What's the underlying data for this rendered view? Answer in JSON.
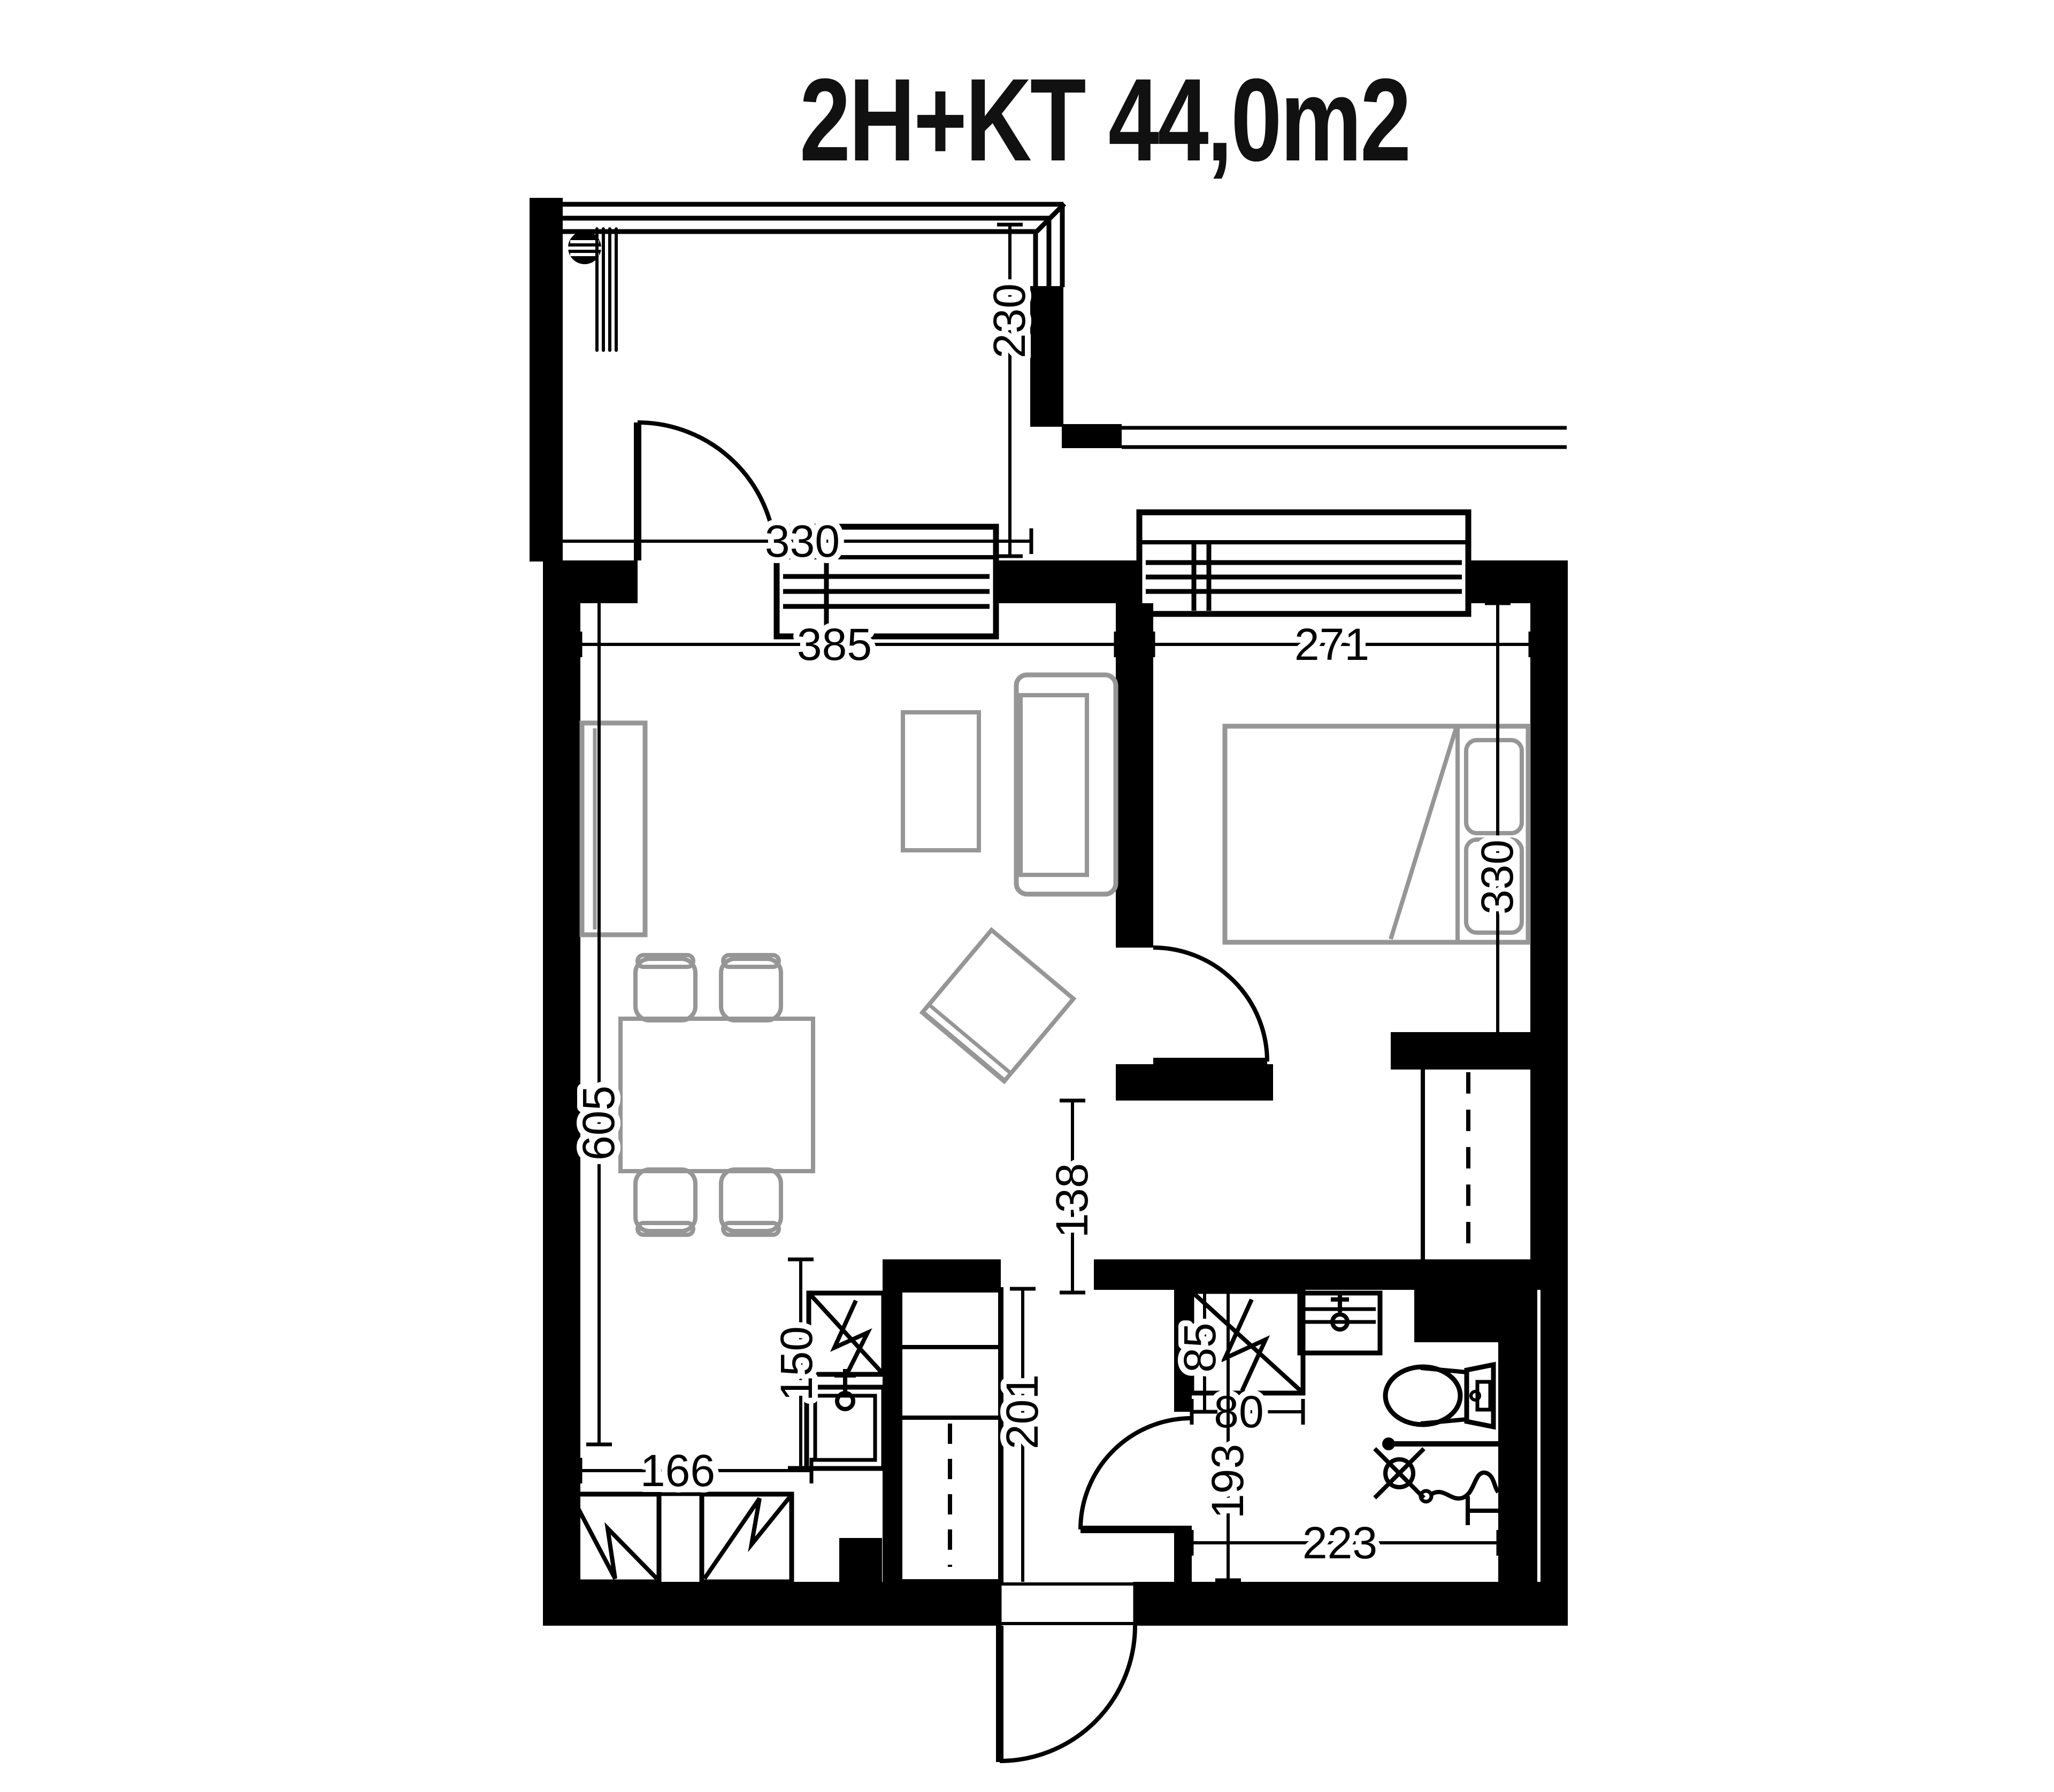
{
  "title": "2H+KT 44,0m2",
  "dims": {
    "balcony_width": "330",
    "balcony_depth": "230",
    "living_width": "385",
    "bedroom_width": "271",
    "bedroom_depth": "330",
    "living_kitchen_depth": "605",
    "kitchen_counter_depth": "150",
    "kitchen_run": "166",
    "tall_cabinet_height": "201",
    "hall_clearance": "138",
    "shower_niche": "85",
    "shower_width": "80",
    "bathroom_depth": "193",
    "bathroom_width": "223"
  },
  "colors": {
    "wall": "#000000",
    "furniture": "#969696",
    "background": "#ffffff"
  }
}
